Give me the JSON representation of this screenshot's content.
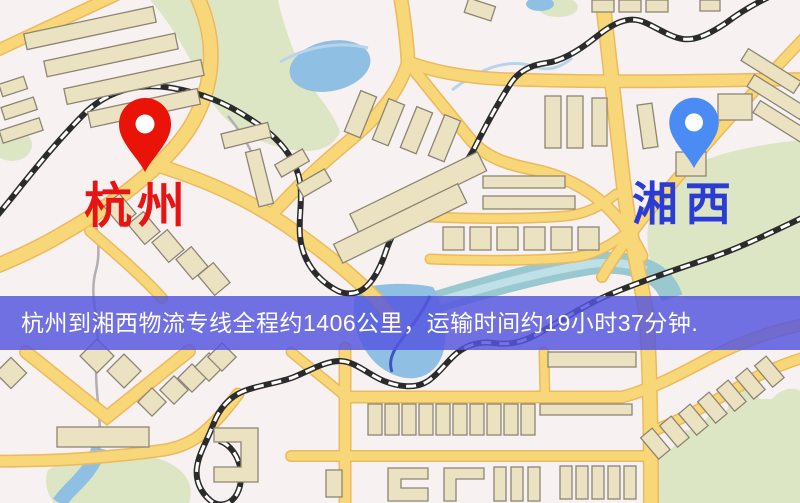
{
  "banner": {
    "text": "杭州到湘西物流专线全程约1406公里，运输时间约19小时37分钟."
  },
  "route": {
    "origin": "杭州",
    "destination": "湘西",
    "distance": "约1406公里",
    "duration": "约19小时37分钟"
  },
  "markers": {
    "origin": {
      "label": "杭州",
      "pin": "red-location-pin"
    },
    "destination": {
      "label": "湘西",
      "pin": "blue-location-pin"
    }
  },
  "colors": {
    "banner_bg": "#5456df",
    "banner_text": "#ffffff",
    "origin_pin": "#ea1308",
    "origin_label": "#e81414",
    "destination_pin": "#4b8cf4",
    "destination_label": "#2b3cd4",
    "road": "#f8d778",
    "road_casing": "#ecb95e",
    "railway": "#2b2b2b",
    "water": "#8fc0e4",
    "river": "#99c8d0",
    "park_green": "#dce6c4",
    "building": "#ebe2c2",
    "building_outline": "#8d8573",
    "map_background": "#f8f1f2"
  }
}
